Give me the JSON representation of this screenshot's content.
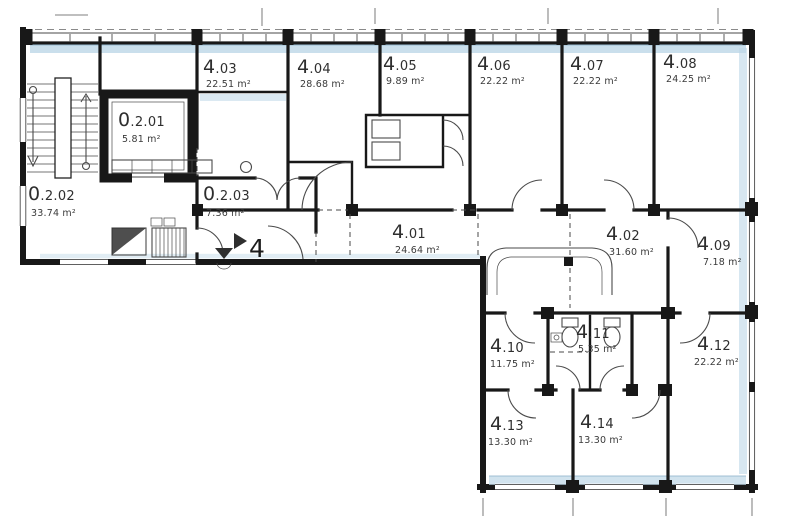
{
  "plan": {
    "level_marker": "4",
    "rooms": {
      "r0201": {
        "big": "0",
        "small": ".2.01",
        "area": "5.81 m²"
      },
      "r0202": {
        "big": "0",
        "small": ".2.02",
        "area": "33.74 m²"
      },
      "r0203": {
        "big": "0",
        "small": ".2.03",
        "area": "7.36 m²"
      },
      "r401": {
        "big": "4",
        "small": ".01",
        "area": "24.64 m²"
      },
      "r402": {
        "big": "4",
        "small": ".02",
        "area": "31.60 m²"
      },
      "r403": {
        "big": "4",
        "small": ".03",
        "area": "22.51 m²"
      },
      "r404": {
        "big": "4",
        "small": ".04",
        "area": "28.68 m²"
      },
      "r405": {
        "big": "4",
        "small": ".05",
        "area": "9.89 m²"
      },
      "r406": {
        "big": "4",
        "small": ".06",
        "area": "22.22 m²"
      },
      "r407": {
        "big": "4",
        "small": ".07",
        "area": "22.22 m²"
      },
      "r408": {
        "big": "4",
        "small": ".08",
        "area": "24.25 m²"
      },
      "r409": {
        "big": "4",
        "small": ".09",
        "area": "7.18 m²"
      },
      "r410": {
        "big": "4",
        "small": ".10",
        "area": "11.75 m²"
      },
      "r411": {
        "big": "4",
        "small": ".11",
        "area": "5.35 m²"
      },
      "r412": {
        "big": "4",
        "small": ".12",
        "area": "22.22 m²"
      },
      "r413": {
        "big": "4",
        "small": ".13",
        "area": "13.30 m²"
      },
      "r414": {
        "big": "4",
        "small": ".14",
        "area": "13.30 m²"
      }
    }
  },
  "colors": {
    "wall": "#181818",
    "ink": "#2e2e2e",
    "ink2": "#4a4a4a",
    "wash": "#bdd7e7",
    "washline": "#8db3cc",
    "paper": "#ffffff"
  }
}
